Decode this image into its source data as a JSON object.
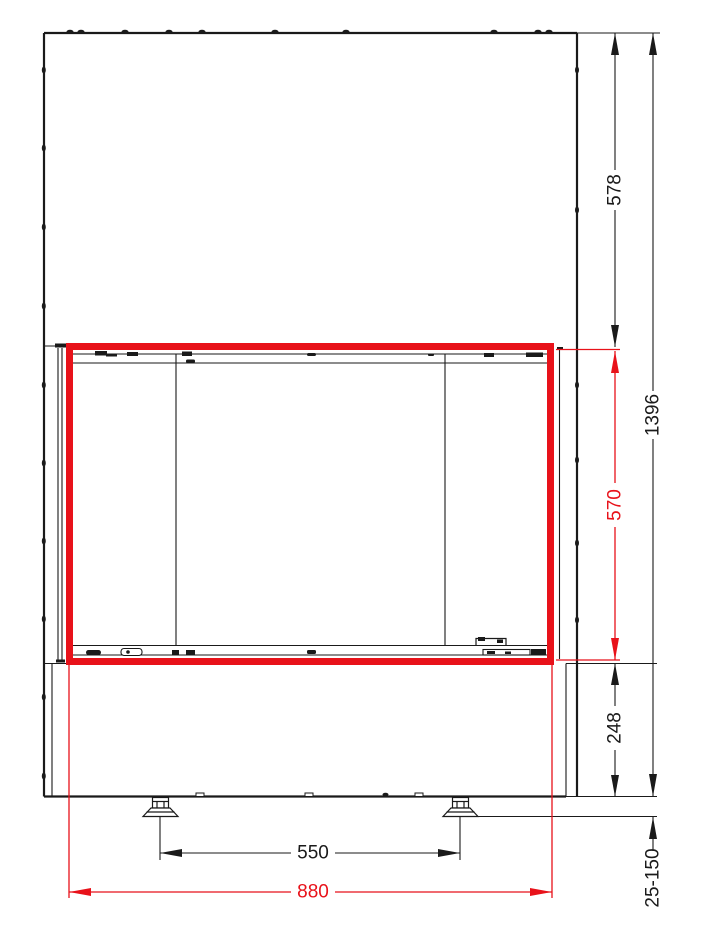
{
  "drawing": {
    "title": "fireplace-insert-front-elevation",
    "units": "mm",
    "colors": {
      "line": "#1a1a1a",
      "highlight": "#e8121a",
      "background": "#ffffff"
    },
    "dimensions": {
      "top_section_height": "578",
      "total_height": "1396",
      "glass_opening_height": "570",
      "base_height": "248",
      "adjustable_feet_range": "25-150",
      "feet_spacing": "550",
      "frame_width": "880"
    }
  }
}
